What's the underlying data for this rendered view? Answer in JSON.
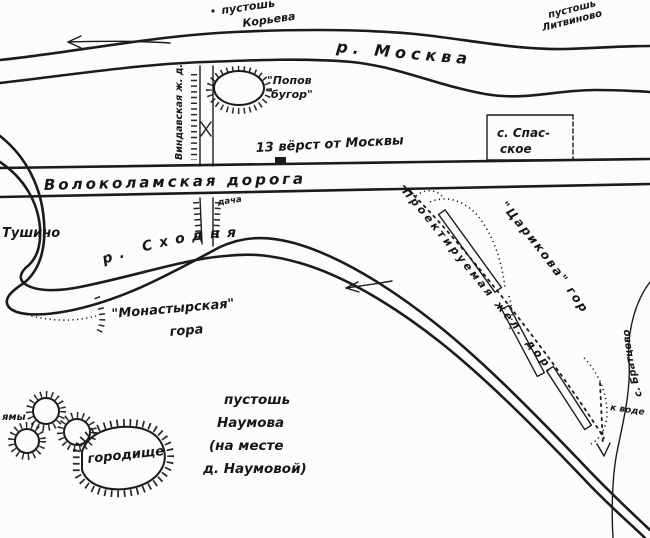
{
  "map": {
    "type": "hand-drawn sketch map (ink on paper)",
    "ink_color": "#1b1b1b",
    "paper_color": "#fdfcfa",
    "labels": {
      "pustosh_koreva_1": "пустошь",
      "pustosh_koreva_2": "Корьева",
      "pustosh_litvinovo_1": "пустошь",
      "pustosh_litvinovo_2": "Литвиново",
      "river_moskva": "р.  Москва",
      "popov_bugor_1": "\"Попов",
      "popov_bugor_2": "бугор\"",
      "versts_marker": "13 вёрст от Москвы",
      "road": "Волоколамская дорога",
      "spasskoye_1": "с. Спас-",
      "spasskoye_2": "ское",
      "tushino": "Тушино",
      "river_skhodnya": "р. Сходня",
      "vertical_line_label": "Виндавская ж. д.",
      "dacha": "дача",
      "monastyrskaya_1": "\"Монастырская\"",
      "monastyrskaya_2": "гора",
      "pustosh_naumova_1": "пустошь",
      "pustosh_naumova_2": "Наумова",
      "pustosh_naumova_3": "(на месте",
      "pustosh_naumova_4": "д. Наумовой)",
      "gorodishche": "городище",
      "yamy": "ямы",
      "tsarikova": "\"Царикова\" гора",
      "projected_railway": "Проектируемая жел. дор.",
      "bratsevo": "с. Братцево",
      "k_vode": "к воде"
    }
  }
}
